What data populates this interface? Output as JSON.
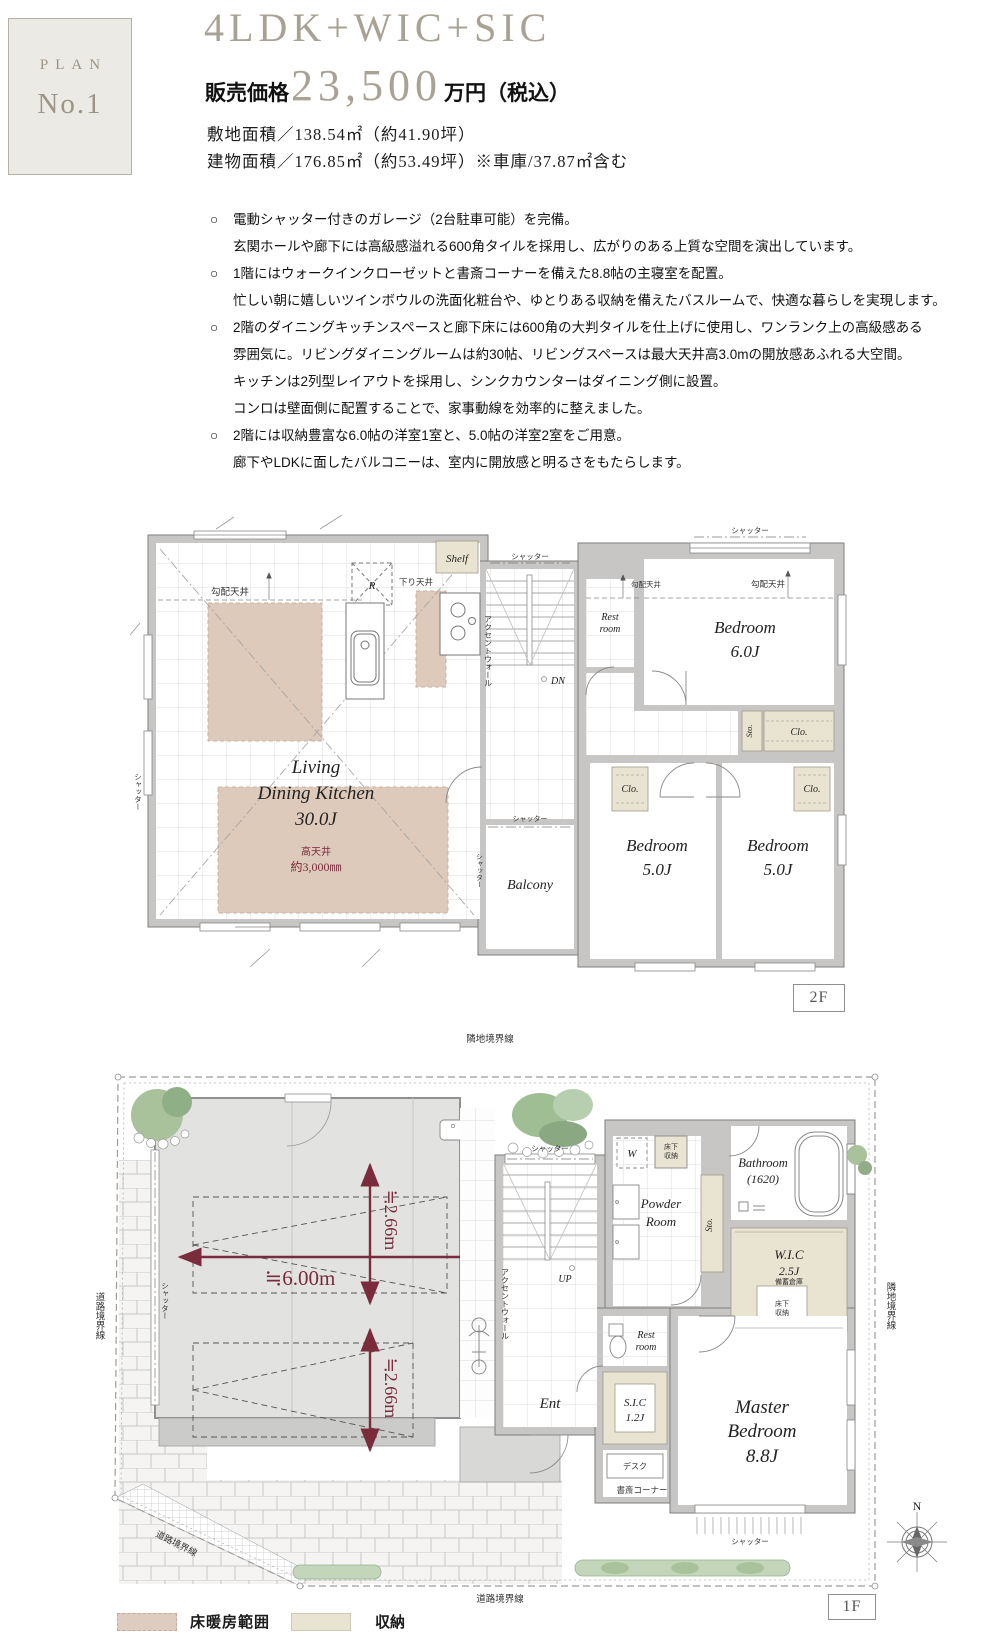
{
  "header": {
    "plan_label": "PLAN",
    "plan_no": "No.1",
    "title": "4LDK+WIC+SIC",
    "price_label": "販売価格",
    "price_value": "23,500",
    "price_unit": "万円（税込）",
    "area_land": "敷地面積／138.54㎡（約41.90坪）",
    "area_building": "建物面積／176.85㎡（約53.49坪）※車庫/37.87㎡含む"
  },
  "features": {
    "bullet": "○",
    "items": [
      {
        "lines": [
          "電動シャッター付きのガレージ（2台駐車可能）を完備。",
          "玄関ホールや廊下には高級感溢れる600角タイルを採用し、広がりのある上質な空間を演出しています。"
        ]
      },
      {
        "lines": [
          "1階にはウォークインクローゼットと書斎コーナーを備えた8.8帖の主寝室を配置。",
          "忙しい朝に嬉しいツインボウルの洗面化粧台や、ゆとりある収納を備えたバスルームで、快適な暮らしを実現します。"
        ]
      },
      {
        "lines": [
          "2階のダイニングキッチンスペースと廊下床には600角の大判タイルを仕上げに使用し、ワンランク上の高級感ある",
          "雰囲気に。リビングダイニングルームは約30帖、リビングスペースは最大天井高3.0mの開放感あふれる大空間。",
          "キッチンは2列型レイアウトを採用し、シンクカウンターはダイニング側に設置。",
          "コンロは壁面側に配置することで、家事動線を効率的に整えました。"
        ]
      },
      {
        "lines": [
          "2階には収納豊富な6.0帖の洋室1室と、5.0帖の洋室2室をご用意。",
          "廊下やLDKに面したバルコニーは、室内に開放感と明るさをもたらします。"
        ]
      }
    ]
  },
  "plan2f": {
    "floor_label": "2F",
    "labels": {
      "slope_ceiling": "勾配天井",
      "shelf": "Shelf",
      "fridge": "R",
      "lowered_ceiling": "下り天井",
      "shutter": "シャッター",
      "accent_wall": "アクセントウォール",
      "down": "DN",
      "living1": "Living",
      "living2": "Dining Kitchen",
      "living_size": "30.0J",
      "high_ceiling1": "高天井",
      "high_ceiling2": "約3,000㎜",
      "rest1": "Rest",
      "rest2": "room",
      "bedroom": "Bedroom",
      "bedroom6_size": "6.0J",
      "bedroom5_size": "5.0J",
      "balcony": "Balcony",
      "closet": "Clo.",
      "storage": "Sto."
    }
  },
  "plan1f": {
    "floor_label": "1F",
    "labels": {
      "boundary_neighbor": "隣地境界線",
      "boundary_road": "道路境界線",
      "shutter": "シャッター",
      "dim_width": "≒6.00m",
      "dim_depth": "≒2.66m",
      "accent_wall": "アクセントウォール",
      "up": "UP",
      "washer": "W",
      "underfloor1": "床下",
      "underfloor2": "収納",
      "powder1": "Powder",
      "powder2": "Room",
      "storage": "Sto.",
      "bathroom1": "Bathroom",
      "bathroom2": "(1620)",
      "wic1": "W.I.C",
      "wic2": "2.5J",
      "stockpile": "備蓄倉庫",
      "rest1": "Rest",
      "rest2": "room",
      "sic1": "S.I.C",
      "sic2": "1.2J",
      "entrance": "Ent",
      "desk": "デスク",
      "study_corner": "書斎コーナー",
      "master1": "Master",
      "master2": "Bedroom",
      "master_size": "8.8J",
      "north": "N"
    }
  },
  "legend": {
    "floor_heating": "床暖房範囲",
    "storage": "収納"
  },
  "colors": {
    "accent_text": "#a9a294",
    "dim_red": "#7a2b3c",
    "wall": "#c7c6c4",
    "floor_heating": "#ddcabb",
    "storage_beige": "#e9e4d2"
  }
}
